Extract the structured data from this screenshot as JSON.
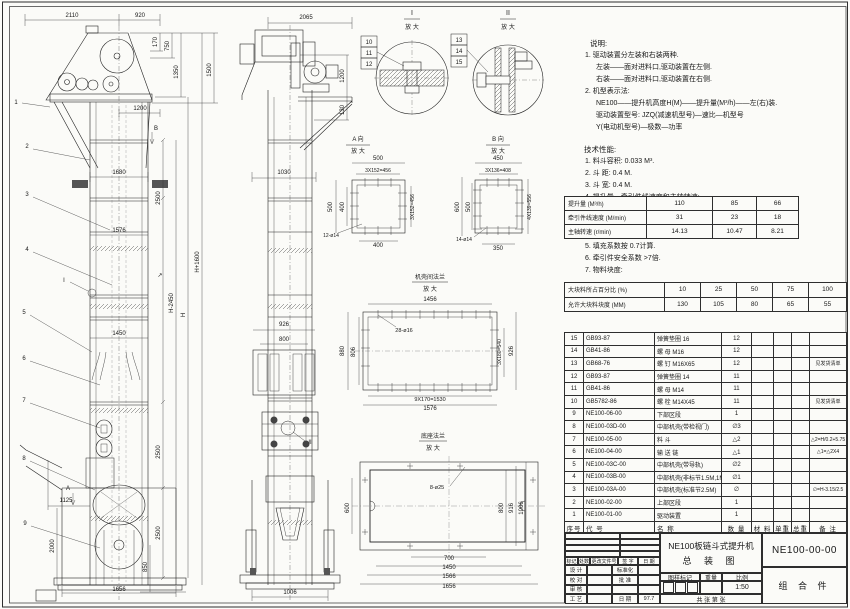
{
  "notes": {
    "heading": "说明:",
    "lines": [
      {
        "t": "1. 驱动装置分左装和右装两种.",
        "i": 1
      },
      {
        "t": "左装——面对进料口,驱动装置在左侧.",
        "i": 2
      },
      {
        "t": "右装——面对进料口,驱动装置在右侧.",
        "i": 2
      },
      {
        "t": "2. 机型表示法:",
        "i": 1
      },
      {
        "t": "NE100——提升机高度H(M)——提升量(M³/h)——左(右)装.",
        "i": 2
      },
      {
        "t": "驱动装置型号: JZQ(减速机型号)—速比—机型号",
        "i": 2
      },
      {
        "t": "Y(电动机型号)—极数—功率",
        "i": 2
      }
    ]
  },
  "tech": {
    "heading": "技术性能:",
    "lines": [
      {
        "t": "1. 料斗容积: 0.033 M³.",
        "i": 1
      },
      {
        "t": "2. 斗  距: 0.4 M.",
        "i": 1
      },
      {
        "t": "3. 斗  宽: 0.4 M.",
        "i": 1
      },
      {
        "t": "4. 提升量、牵引件线速度和主轴转速:",
        "i": 1
      }
    ]
  },
  "notes2": {
    "lines": [
      {
        "t": "5. 填充系数按 0.7计算.",
        "i": 1
      },
      {
        "t": "6. 牵引件安全系数 >7倍.",
        "i": 1
      },
      {
        "t": "7. 物料块度:",
        "i": 1
      }
    ]
  },
  "tables": {
    "perf": {
      "widths": [
        82,
        66,
        44,
        42
      ],
      "rows": [
        [
          "提升量 (M³/h)",
          "110",
          "85",
          "66"
        ],
        [
          "牵引件线速度 (M/min)",
          "31",
          "23",
          "18"
        ],
        [
          "主轴转速 (r/min)",
          "14.13",
          "10.47",
          "8.21"
        ]
      ]
    },
    "lump": {
      "widths": [
        100,
        36,
        36,
        36,
        36,
        38
      ],
      "rows": [
        [
          "大块料所占百分比 (%)",
          "10",
          "25",
          "50",
          "75",
          "100"
        ],
        [
          "允许大块料块度 (MM)",
          "130",
          "105",
          "80",
          "65",
          "55"
        ]
      ]
    }
  },
  "parts": {
    "widths": [
      19,
      71,
      67,
      30,
      22,
      18,
      18,
      37
    ],
    "headers": [
      "序号",
      "代  号",
      "名  称",
      "数 量",
      "材  料",
      "单重",
      "总重",
      "备  注"
    ],
    "rows": [
      [
        "15",
        "GB93-87",
        "弹簧垫圈 16",
        "12",
        "",
        "",
        "",
        ""
      ],
      [
        "14",
        "GB41-86",
        "螺 母  M16",
        "12",
        "",
        "",
        "",
        ""
      ],
      [
        "13",
        "GB68-76",
        "螺 钉  M16X65",
        "12",
        "",
        "",
        "",
        "见发货清单"
      ],
      [
        "12",
        "GB93-87",
        "弹簧垫圈 14",
        "11",
        "",
        "",
        "",
        ""
      ],
      [
        "11",
        "GB41-86",
        "螺 母  M14",
        "11",
        "",
        "",
        "",
        ""
      ],
      [
        "10",
        "GB5782-86",
        "螺 栓  M14X45",
        "11",
        "",
        "",
        "",
        "见发货清单"
      ],
      [
        "9",
        "NE100-06-00",
        "下部区段",
        "1",
        "",
        "",
        "",
        ""
      ],
      [
        "8",
        "NE100-03D-00",
        "中部机壳(带检视门)",
        "∅3",
        "",
        "",
        "",
        ""
      ],
      [
        "7",
        "NE100-05-00",
        "料 斗",
        "△2",
        "",
        "",
        "",
        "△2=H/0.2+5.75"
      ],
      [
        "6",
        "NE100-04-00",
        "输 送 链",
        "△1",
        "",
        "",
        "",
        "△1=△2X4"
      ],
      [
        "5",
        "NE100-03C-00",
        "中部机壳(带导轨)",
        "∅2",
        "",
        "",
        "",
        ""
      ],
      [
        "4",
        "NE100-03B-00",
        "中部机壳(非标节1.5M,1M)",
        "∅1",
        "",
        "",
        "",
        ""
      ],
      [
        "3",
        "NE100-03A-00",
        "中部机壳(标准节2.5M)",
        "∅",
        "",
        "",
        "",
        "∅=H-3.15/2.5"
      ],
      [
        "2",
        "NE100-02-00",
        "上部区段",
        "1",
        "",
        "",
        "",
        ""
      ],
      [
        "1",
        "NE100-01-00",
        "驱动装置",
        "1",
        "",
        "",
        "",
        ""
      ]
    ]
  },
  "title_block": {
    "rev_headers": [
      "标记",
      "处数",
      "更改文件号",
      "签 字",
      "日 期"
    ],
    "sign_rows": [
      {
        "a": "设 计",
        "b": "标准化",
        "c": ""
      },
      {
        "a": "校 对",
        "b": "批 准",
        "c": ""
      },
      {
        "a": "审 核",
        "b": "",
        "c": ""
      },
      {
        "a": "工 艺",
        "b": "日 期",
        "c": "97.7"
      }
    ],
    "title1": "NE100板链斗式提升机",
    "title2": "总  装  图",
    "stamp_headers": [
      "图样标记",
      "重量",
      "比例"
    ],
    "scale": "1:50",
    "sheet_row": "共  张  第  张",
    "drawing_no": "NE100-00-00",
    "part_kind": "组 合 件"
  },
  "drawing": {
    "labels": [
      {
        "t": "2110",
        "x": 72,
        "y": 17
      },
      {
        "t": "920",
        "x": 140,
        "y": 17
      },
      {
        "t": "1200",
        "x": 140,
        "y": 110
      },
      {
        "t": "170",
        "x": 157,
        "y": 42,
        "r": -90
      },
      {
        "t": "750",
        "x": 169,
        "y": 46,
        "r": -90
      },
      {
        "t": "1350",
        "x": 178,
        "y": 72,
        "r": -90
      },
      {
        "t": "1500",
        "x": 211,
        "y": 70,
        "r": -90
      },
      {
        "t": "1680",
        "x": 119,
        "y": 174
      },
      {
        "t": "2500",
        "x": 160,
        "y": 198,
        "r": -90
      },
      {
        "t": "1576",
        "x": 119,
        "y": 232
      },
      {
        "t": "↗",
        "x": 160,
        "y": 277
      },
      {
        "t": "H+1600",
        "x": 199,
        "y": 262,
        "r": -90
      },
      {
        "t": "H-2450",
        "x": 173,
        "y": 303,
        "r": -90
      },
      {
        "t": "H",
        "x": 185,
        "y": 315,
        "r": -90
      },
      {
        "t": "1450",
        "x": 119,
        "y": 335
      },
      {
        "t": "2500",
        "x": 160,
        "y": 452,
        "r": -90
      },
      {
        "t": "2500",
        "x": 160,
        "y": 533,
        "r": -90
      },
      {
        "t": "1125",
        "x": 66,
        "y": 502
      },
      {
        "t": "2000",
        "x": 54,
        "y": 546,
        "r": -90
      },
      {
        "t": "850",
        "x": 147,
        "y": 567,
        "r": -90
      },
      {
        "t": "1656",
        "x": 119,
        "y": 591
      },
      {
        "t": "1",
        "x": 16,
        "y": 104,
        "n": "callout-1"
      },
      {
        "t": "2",
        "x": 27,
        "y": 148,
        "n": "callout-2"
      },
      {
        "t": "3",
        "x": 27,
        "y": 196,
        "n": "callout-3"
      },
      {
        "t": "4",
        "x": 27,
        "y": 251,
        "n": "callout-4"
      },
      {
        "t": "5",
        "x": 24,
        "y": 314,
        "n": "callout-5"
      },
      {
        "t": "6",
        "x": 24,
        "y": 360,
        "n": "callout-6"
      },
      {
        "t": "7",
        "x": 24,
        "y": 402,
        "n": "callout-7"
      },
      {
        "t": "8",
        "x": 24,
        "y": 460,
        "n": "callout-8"
      },
      {
        "t": "9",
        "x": 25,
        "y": 525,
        "n": "callout-9"
      },
      {
        "t": "I",
        "x": 64,
        "y": 282,
        "n": "section-mark-i"
      },
      {
        "t": "A",
        "x": 68,
        "y": 490,
        "n": "view-mark-a"
      },
      {
        "t": "B",
        "x": 156,
        "y": 130,
        "n": "view-mark-b"
      },
      {
        "t": "2065",
        "x": 306,
        "y": 19
      },
      {
        "t": "1200",
        "x": 344,
        "y": 76,
        "r": -90
      },
      {
        "t": "130",
        "x": 344,
        "y": 110,
        "r": -90
      },
      {
        "t": "1030",
        "x": 284,
        "y": 174
      },
      {
        "t": "926",
        "x": 284,
        "y": 326
      },
      {
        "t": "800",
        "x": 284,
        "y": 341
      },
      {
        "t": "II",
        "x": 310,
        "y": 444,
        "n": "section-mark-ii"
      },
      {
        "t": "1006",
        "x": 290,
        "y": 594
      },
      {
        "t": "I",
        "x": 412,
        "y": 15,
        "s": 7
      },
      {
        "t": "放 大",
        "x": 412,
        "y": 29
      },
      {
        "t": "10",
        "x": 369,
        "y": 44,
        "n": "callout-10"
      },
      {
        "t": "11",
        "x": 369,
        "y": 55,
        "n": "callout-11"
      },
      {
        "t": "12",
        "x": 369,
        "y": 66,
        "n": "callout-12"
      },
      {
        "t": "II",
        "x": 508,
        "y": 15,
        "s": 7
      },
      {
        "t": "放 大",
        "x": 508,
        "y": 29
      },
      {
        "t": "13",
        "x": 459,
        "y": 42,
        "n": "callout-13"
      },
      {
        "t": "14",
        "x": 459,
        "y": 53,
        "n": "callout-14"
      },
      {
        "t": "15",
        "x": 459,
        "y": 64,
        "n": "callout-15"
      },
      {
        "t": "A 向",
        "x": 358,
        "y": 141
      },
      {
        "t": "放 大",
        "x": 358,
        "y": 153
      },
      {
        "t": "500",
        "x": 378,
        "y": 160
      },
      {
        "t": "3X152=456",
        "x": 378,
        "y": 172,
        "s": 5
      },
      {
        "t": "500",
        "x": 332,
        "y": 207,
        "r": -90
      },
      {
        "t": "400",
        "x": 344,
        "y": 207,
        "r": -90
      },
      {
        "t": "3X152=456",
        "x": 414,
        "y": 207,
        "r": -90,
        "s": 5
      },
      {
        "t": "400",
        "x": 378,
        "y": 247
      },
      {
        "t": "12-ø14",
        "x": 331,
        "y": 237,
        "s": 5
      },
      {
        "t": "B 向",
        "x": 498,
        "y": 141
      },
      {
        "t": "放 大",
        "x": 498,
        "y": 153
      },
      {
        "t": "450",
        "x": 498,
        "y": 160
      },
      {
        "t": "3X136=408",
        "x": 498,
        "y": 172,
        "s": 5
      },
      {
        "t": "600",
        "x": 459,
        "y": 207,
        "r": -90
      },
      {
        "t": "500",
        "x": 470,
        "y": 207,
        "r": -90
      },
      {
        "t": "4X139=556",
        "x": 531,
        "y": 207,
        "r": -90,
        "s": 5
      },
      {
        "t": "350",
        "x": 498,
        "y": 250
      },
      {
        "t": "14-ø14",
        "x": 464,
        "y": 241,
        "s": 5
      },
      {
        "t": "机壳间法兰",
        "x": 430,
        "y": 279
      },
      {
        "t": "放 大",
        "x": 430,
        "y": 291
      },
      {
        "t": "1456",
        "x": 430,
        "y": 301
      },
      {
        "t": "28-ø16",
        "x": 404,
        "y": 332,
        "s": 5.5
      },
      {
        "t": "880",
        "x": 344,
        "y": 351,
        "r": -90
      },
      {
        "t": "806",
        "x": 355,
        "y": 352,
        "r": -90
      },
      {
        "t": "3X180=540",
        "x": 501,
        "y": 352,
        "r": -90,
        "s": 5
      },
      {
        "t": "926",
        "x": 513,
        "y": 351,
        "r": -90
      },
      {
        "t": "9X170=1530",
        "x": 430,
        "y": 401,
        "s": 5.5
      },
      {
        "t": "1576",
        "x": 430,
        "y": 410
      },
      {
        "t": "底座法兰",
        "x": 433,
        "y": 438
      },
      {
        "t": "放 大",
        "x": 433,
        "y": 450
      },
      {
        "t": "8-ø25",
        "x": 437,
        "y": 489,
        "s": 5.5
      },
      {
        "t": "600",
        "x": 349,
        "y": 508,
        "r": -90
      },
      {
        "t": "800",
        "x": 503,
        "y": 508,
        "r": -90
      },
      {
        "t": "916",
        "x": 513,
        "y": 508,
        "r": -90
      },
      {
        "t": "1006",
        "x": 523,
        "y": 508,
        "r": -90
      },
      {
        "t": "700",
        "x": 449,
        "y": 560
      },
      {
        "t": "1450",
        "x": 449,
        "y": 569
      },
      {
        "t": "1566",
        "x": 449,
        "y": 578
      },
      {
        "t": "1656",
        "x": 449,
        "y": 588
      }
    ]
  }
}
